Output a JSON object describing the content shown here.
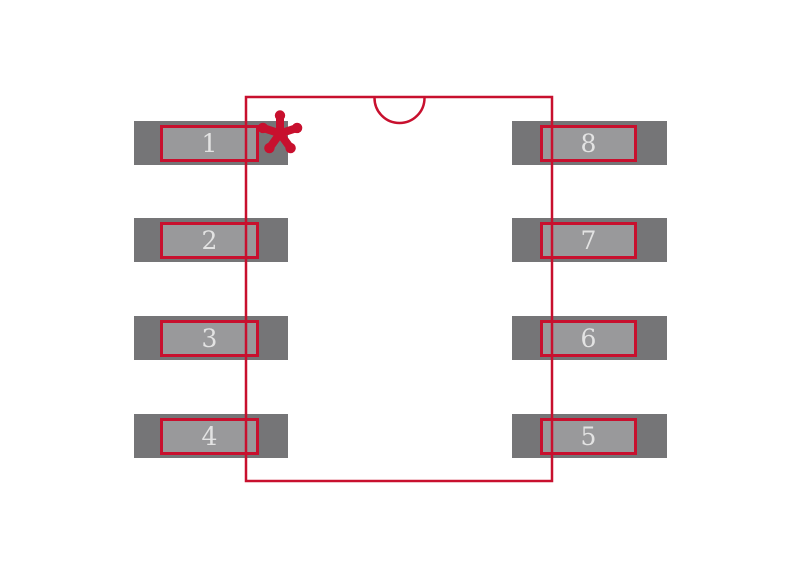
{
  "footprint": {
    "colors": {
      "outline": "#c8102e",
      "pad_outer": "#757577",
      "pad_inner": "#99999b",
      "pad_number": "#e3e3e3",
      "background": "#ffffff"
    },
    "pin1_marker_glyph": "✱",
    "pads": [
      {
        "number": "1"
      },
      {
        "number": "2"
      },
      {
        "number": "3"
      },
      {
        "number": "4"
      },
      {
        "number": "5"
      },
      {
        "number": "6"
      },
      {
        "number": "7"
      },
      {
        "number": "8"
      }
    ]
  }
}
